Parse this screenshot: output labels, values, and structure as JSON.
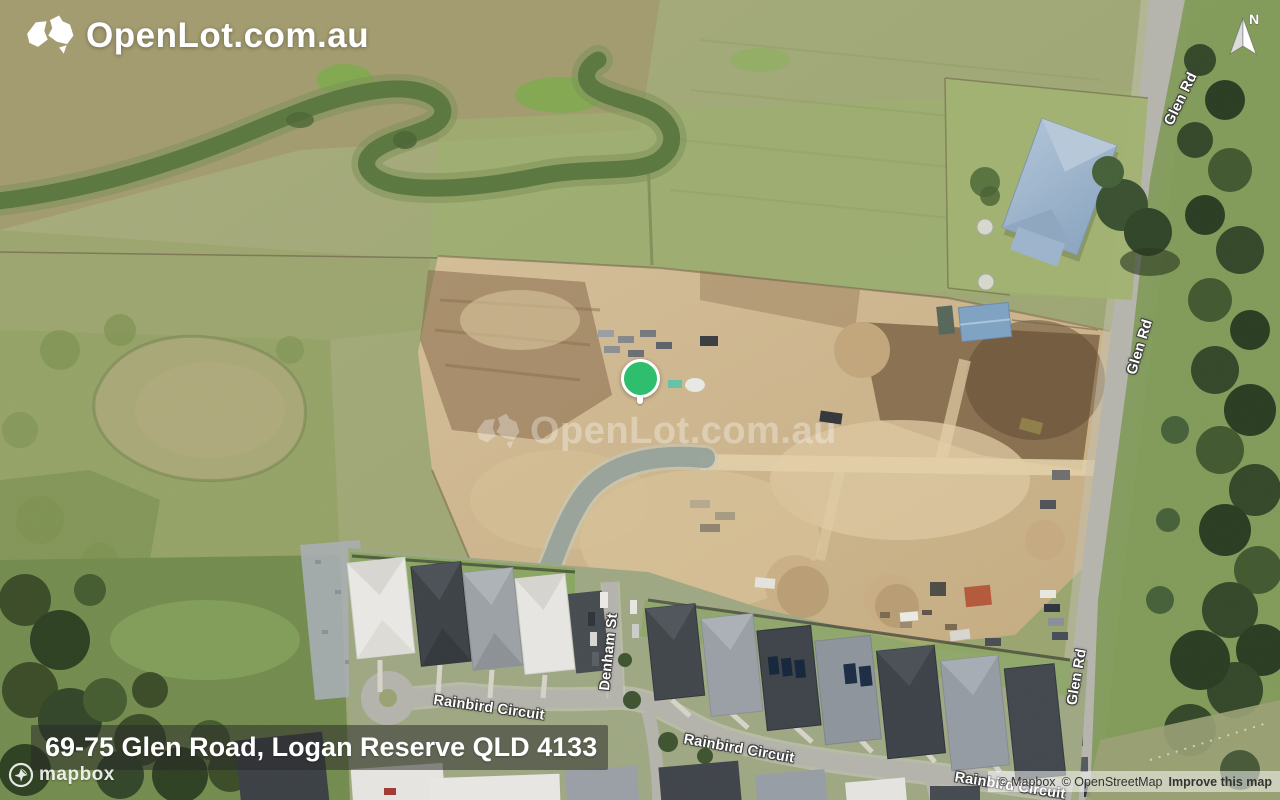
{
  "branding": {
    "logo_text": "OpenLot.com.au"
  },
  "watermark": {
    "text": "OpenLot.com.au"
  },
  "compass": {
    "north_label": "N"
  },
  "marker": {
    "type": "location-pin",
    "color": "#2ebe6e"
  },
  "address_bar": {
    "address": "69-75 Glen Road, Logan Reserve QLD 4133"
  },
  "map_labels": {
    "glen_rd_top": "Glen Rd",
    "glen_rd_mid": "Glen Rd",
    "glen_rd_bottom": "Glen Rd",
    "denham_st": "Denham St",
    "rainbird_circuit_west": "Rainbird Circuit",
    "rainbird_circuit_east": "Rainbird Circuit",
    "rainbird_circuit_south": "Rainbird Circuit"
  },
  "attribution": {
    "mapbox_wordmark": "mapbox",
    "mapbox_copyright": "© Mapbox",
    "osm_copyright": "© OpenStreetMap",
    "improve_label": "Improve this map"
  },
  "colors": {
    "pin_green": "#2ebe6e",
    "address_overlay_bg": "rgba(40,40,40,0.52)",
    "attribution_bg": "rgba(255,255,255,0.5)",
    "logo_text": "#ffffff"
  }
}
